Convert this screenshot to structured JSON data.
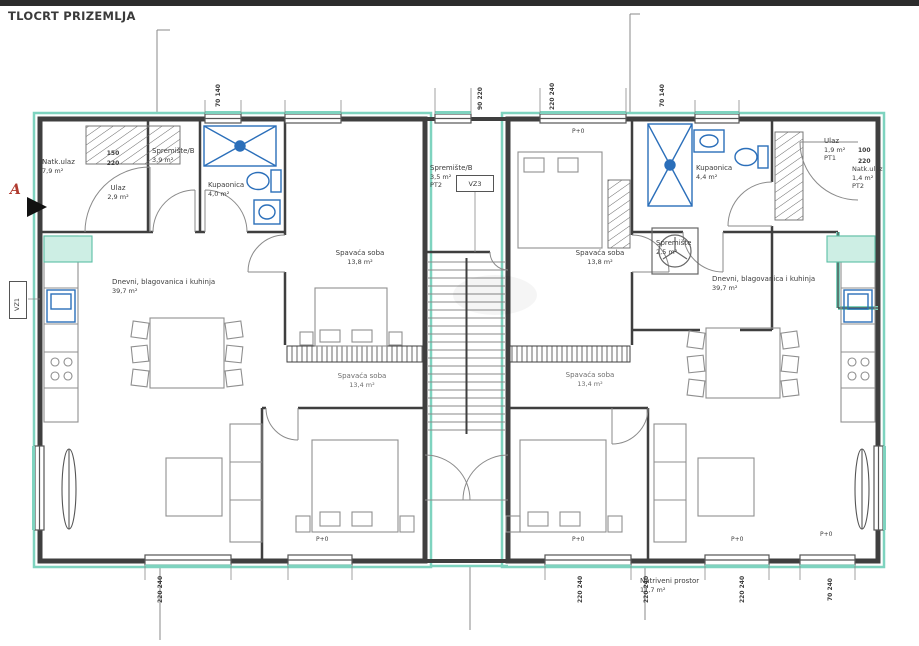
{
  "title": "TLOCRT PRIZEMLJA",
  "section_marker": "A",
  "codes": {
    "p0": "P+0",
    "vz1": "VZ1",
    "vz3": "VZ3"
  },
  "rooms": {
    "natk_ulaz_left": {
      "name": "Natk.ulaz",
      "area": "7,9 m²"
    },
    "ulaz_left": {
      "name": "Ulaz",
      "area": "2,9 m²"
    },
    "spremiste_b_left": {
      "name": "Spremište/B",
      "area": "3,9 m²"
    },
    "kupaonica_left": {
      "name": "Kupaonica",
      "area": "4,0 m²"
    },
    "spavaca_soba_left_1": {
      "name": "Spavaća soba",
      "area": "13,8 m²"
    },
    "dnevni_left": {
      "name": "Dnevni, blagovanica i kuhinja",
      "area": "39,7 m²"
    },
    "spavaca_soba_left_2": {
      "name": "Spavaća soba",
      "area": "13,4 m²"
    },
    "spremiste_b_center": {
      "name": "Spremište/B",
      "area": "3,5 m²",
      "code": "PT2"
    },
    "spavaca_soba_right_1": {
      "name": "Spavaća soba",
      "area": "13,8 m²"
    },
    "kupaonica_right": {
      "name": "Kupaonica",
      "area": "4,4 m²"
    },
    "ulaz_right": {
      "name": "Ulaz",
      "area": "1,9 m²",
      "code": "PT1"
    },
    "natk_ulaz_right": {
      "name": "Natk.ulaz",
      "area": "1,4 m²",
      "code": "PT2"
    },
    "spremiste_right": {
      "name": "Spremište",
      "area": "2,5 m²"
    },
    "dnevni_right": {
      "name": "Dnevni, blagovanica i kuhinja",
      "area": "39,7 m²"
    },
    "spavaca_soba_right_2": {
      "name": "Spavaća soba",
      "area": "13,4 m²"
    },
    "natkriveni_prostor": {
      "name": "Natriveni prostor",
      "area": "11,7 m²"
    }
  },
  "dimensions": {
    "top_left_window": "70 140",
    "top_center": "90 220",
    "top_center_right": "220 240",
    "top_right_window": "70 140",
    "entry_left_w": "150",
    "entry_left_h": "220",
    "entry_right_w": "100",
    "entry_right_h": "220",
    "bottom_1": "220 240",
    "bottom_2": "220 240",
    "bottom_3": "220 240",
    "bottom_4": "220 240",
    "bottom_right": "70 240"
  },
  "colors": {
    "wall": "#3f3f3f",
    "insulation": "#7ed3bf",
    "fixture_blue": "#2b6fba",
    "marker_red": "#b03a2e"
  }
}
